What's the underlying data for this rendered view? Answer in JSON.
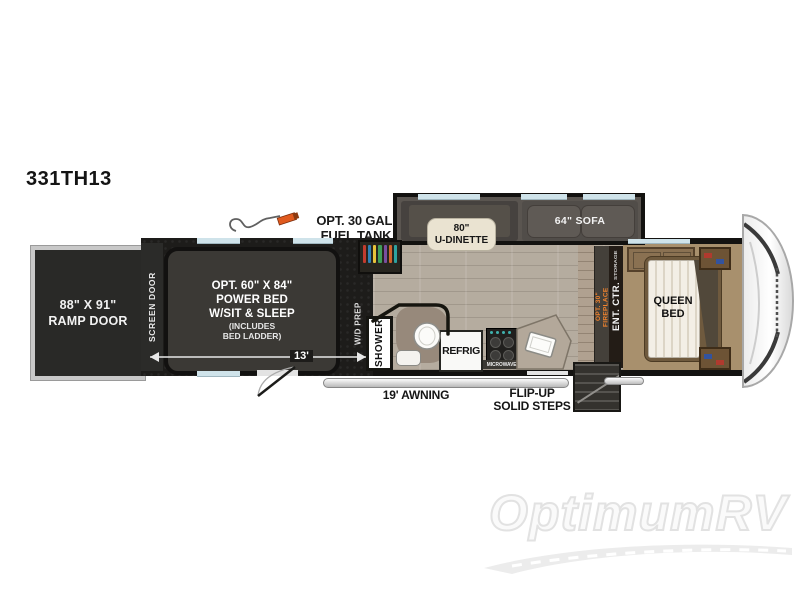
{
  "title": "331TH13",
  "watermark": "OptimumRV",
  "floorplan": {
    "rear": {
      "ramp_door": "88\" X 91\"\nRAMP DOOR",
      "screen_door": "SCREEN DOOR"
    },
    "garage": {
      "power_bed": "OPT. 60\" X 84\"\nPOWER BED\nW/SIT & SLEEP",
      "power_bed_note": "(INCLUDES\nBED LADDER)",
      "wd_prep": "W/D PREP",
      "length": "13'"
    },
    "options": {
      "fuel_tank": "OPT. 30 GAL.\nFUEL TANK"
    },
    "living": {
      "dinette": "80\"\nU-DINETTE",
      "sofa": "64\" SOFA",
      "shower": "SHOWER",
      "refrigerator": "REFRIG",
      "microwave": "MICROWAVE",
      "fireplace_line1": "OPT. 30\"",
      "fireplace_line2": "FIREPLACE",
      "ent_ctr": "ENT. CTR.",
      "storage": "STORAGE"
    },
    "bedroom": {
      "queen_bed": "QUEEN\nBED"
    },
    "exterior": {
      "awning": "19' AWNING",
      "steps": "FLIP-UP\nSOLID STEPS"
    }
  },
  "colors": {
    "garage_floor": "#1d1c1a",
    "wall": "#141311",
    "wood_floor": "#b5ac9f",
    "bedroom_carpet": "#a8906d",
    "slide_gray": "#5a5550",
    "dinette_label_cream": "#eae3d1",
    "fireplace_text_orange": "#f0822d",
    "fuel_nozzle_orange": "#e05a1e",
    "window_blue": "#cfe3ea",
    "watermark_gray": "#e2e2e2"
  }
}
